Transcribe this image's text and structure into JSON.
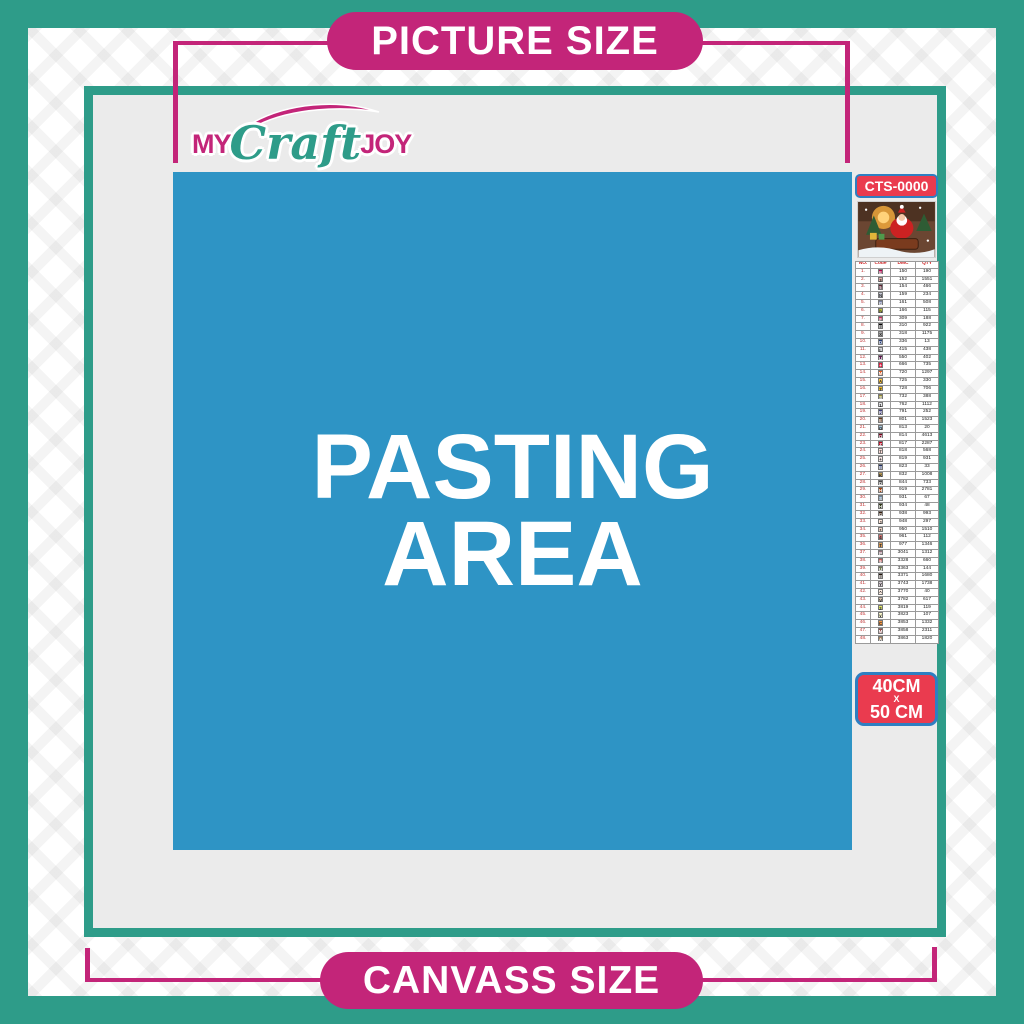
{
  "banners": {
    "top_label": "PICTURE SIZE",
    "bottom_label": "CANVASS SIZE"
  },
  "logo": {
    "word_my": "MY",
    "word_craft": "Craft",
    "word_joy": "JOY"
  },
  "pasting_area": {
    "line1": "PASTING",
    "line2": "AREA"
  },
  "product_code": "CTS-0000",
  "canvas_size": {
    "line1": "40CM",
    "separator": "X",
    "line2": "50 CM"
  },
  "thumbnail": {
    "subject": "santa-claus-christmas-artwork"
  },
  "colors": {
    "teal": "#2E9C89",
    "magenta": "#C32579",
    "blue": "#2E94C5",
    "board_gray": "#EBEBEB",
    "badge_red": "#EA3B4F",
    "badge_border_blue": "#2E7FC2",
    "table_header_red": "#CC2222"
  },
  "color_table": {
    "headers": [
      "NO.",
      "Code",
      "DMC",
      "QTY"
    ],
    "rows": [
      [
        "1.",
        "E",
        "#AB0249",
        "150",
        "190"
      ],
      [
        "2.",
        "3",
        "#E2AFA6",
        "152",
        "1551"
      ],
      [
        "3.",
        "5",
        "#572433",
        "154",
        "466"
      ],
      [
        "4.",
        "N",
        "#C7CAD7",
        "159",
        "234"
      ],
      [
        "5.",
        "G",
        "#7880A4",
        "161",
        "508"
      ],
      [
        "6.",
        "h",
        "#C0C840",
        "166",
        "115"
      ],
      [
        "7.",
        "F",
        "#C73058",
        "309",
        "188"
      ],
      [
        "8.",
        "B",
        "#000000",
        "310",
        "922"
      ],
      [
        "9.",
        "X",
        "#ABABAB",
        "318",
        "1175"
      ],
      [
        "10.",
        "D",
        "#253B73",
        "336",
        "13"
      ],
      [
        "11.",
        "L",
        "#D3D3D6",
        "415",
        "438"
      ],
      [
        "12.",
        "U",
        "#5C184E",
        "550",
        "402"
      ],
      [
        "13.",
        "+",
        "#E31D42",
        "666",
        "735"
      ],
      [
        "14.",
        "M",
        "#E55C1F",
        "720",
        "1297"
      ],
      [
        "15.",
        "A",
        "#FFC840",
        "725",
        "330"
      ],
      [
        "16.",
        "7",
        "#EDB820",
        "728",
        "706"
      ],
      [
        "17.",
        "S",
        "#948C36",
        "732",
        "388"
      ],
      [
        "18.",
        "1",
        "#E6E6E9",
        "762",
        "1112"
      ],
      [
        "19.",
        "R",
        "#3C3B78",
        "791",
        "252"
      ],
      [
        "20.",
        "E",
        "#653919",
        "801",
        "1523"
      ],
      [
        "21.",
        "O",
        "#A1C2D7",
        "813",
        "20"
      ],
      [
        "22.",
        "Q",
        "#7B001B",
        "814",
        "4613"
      ],
      [
        "23.",
        "Z",
        "#BB051F",
        "817",
        "2287"
      ],
      [
        "24.",
        "7",
        "#FFDFD9",
        "818",
        "568"
      ],
      [
        "25.",
        "+",
        "#F8E9E7",
        "819",
        "931"
      ],
      [
        "26.",
        "B",
        "#213063",
        "823",
        "33"
      ],
      [
        "27.",
        "K",
        "#BD9B51",
        "832",
        "1008"
      ],
      [
        "28.",
        "D",
        "#484848",
        "844",
        "733"
      ],
      [
        "29.",
        "H",
        "#A64510",
        "919",
        "2781"
      ],
      [
        "30.",
        "S",
        "#6A859E",
        "931",
        "67"
      ],
      [
        "31.",
        "H",
        "#313919",
        "934",
        "48"
      ],
      [
        "32.",
        "G",
        "#361F0E",
        "938",
        "993"
      ],
      [
        "33.",
        "J",
        "#FEE7DA",
        "948",
        "297"
      ],
      [
        "34.",
        "*",
        "#EED3C4",
        "950",
        "1510"
      ],
      [
        "35.",
        "4",
        "#CF7373",
        "961",
        "112"
      ],
      [
        "36.",
        "T",
        "#DC9C56",
        "977",
        "1346"
      ],
      [
        "37.",
        "P",
        "#956F7C",
        "3041",
        "1312"
      ],
      [
        "38.",
        "9",
        "#C65A5A",
        "3328",
        "660"
      ],
      [
        "39.",
        "U",
        "#727B4E",
        "3363",
        "144"
      ],
      [
        "40.",
        "B",
        "#1E1108",
        "3371",
        "1680"
      ],
      [
        "41.",
        "Y",
        "#D7CBD3",
        "3743",
        "1738"
      ],
      [
        "42.",
        "^",
        "#FFEEE3",
        "3770",
        "40"
      ],
      [
        "43.",
        "V",
        "#D2BCA6",
        "3782",
        "617"
      ],
      [
        "44.",
        "2",
        "#E0E868",
        "3819",
        "119"
      ],
      [
        "45.",
        "v",
        "#FDF9CD",
        "3823",
        "107"
      ],
      [
        "46.",
        "C",
        "#F29746",
        "3853",
        "1332"
      ],
      [
        "47.",
        "M",
        "#964A4A",
        "3858",
        "2311"
      ],
      [
        "48.",
        "A",
        "#A4835C",
        "3863",
        "1820"
      ]
    ]
  }
}
